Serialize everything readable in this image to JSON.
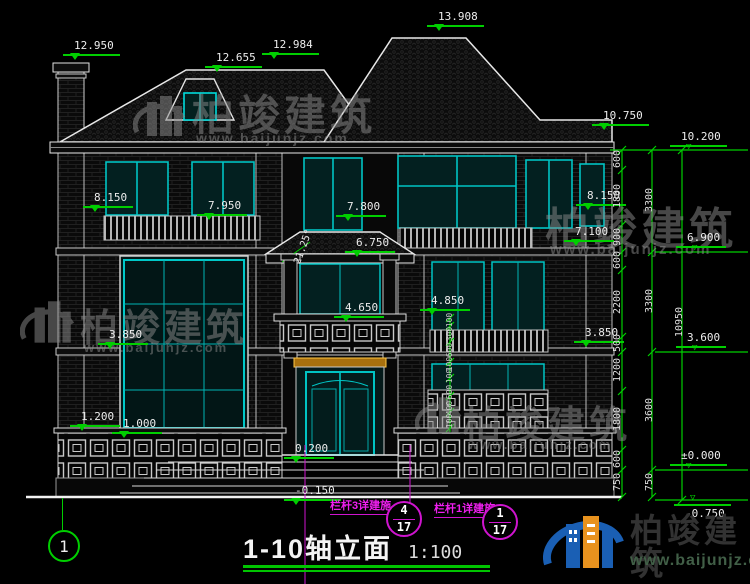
{
  "brand": {
    "name": "柏竣建筑",
    "url": "www.baijunjz.com"
  },
  "title": {
    "name": "1-10轴立面",
    "scale": "1:100"
  },
  "axis_bubble": {
    "label": "1"
  },
  "angle": {
    "label": "21.25°"
  },
  "elevations": [
    "12.950",
    "12.655",
    "12.984",
    "13.908",
    "10.750",
    "10.200",
    "8.150",
    "7.950",
    "7.800",
    "8.150",
    "7.100",
    "6.750",
    "6.900",
    "4.650",
    "4.850",
    "3.850",
    "3.850",
    "3.600",
    "1.200",
    "1.000",
    "0.200",
    "±0.000",
    "-0.150",
    "-0.750"
  ],
  "dim_chain_inner": [
    "600",
    "1800",
    "900",
    "600",
    "2200",
    "500",
    "1200",
    "1800",
    "600",
    "750"
  ],
  "dim_chain_floors": [
    "3300",
    "3300",
    "3600",
    "750"
  ],
  "dim_chain_total": [
    "10950"
  ],
  "dim_chain_porch": [
    "100",
    "300",
    "600",
    "100",
    "100",
    "600",
    "400",
    "100"
  ],
  "details": [
    {
      "label": "栏杆3详建施",
      "num": "4",
      "sheet": "17"
    },
    {
      "label": "栏杆1详建施",
      "num": "1",
      "sheet": "17"
    }
  ]
}
